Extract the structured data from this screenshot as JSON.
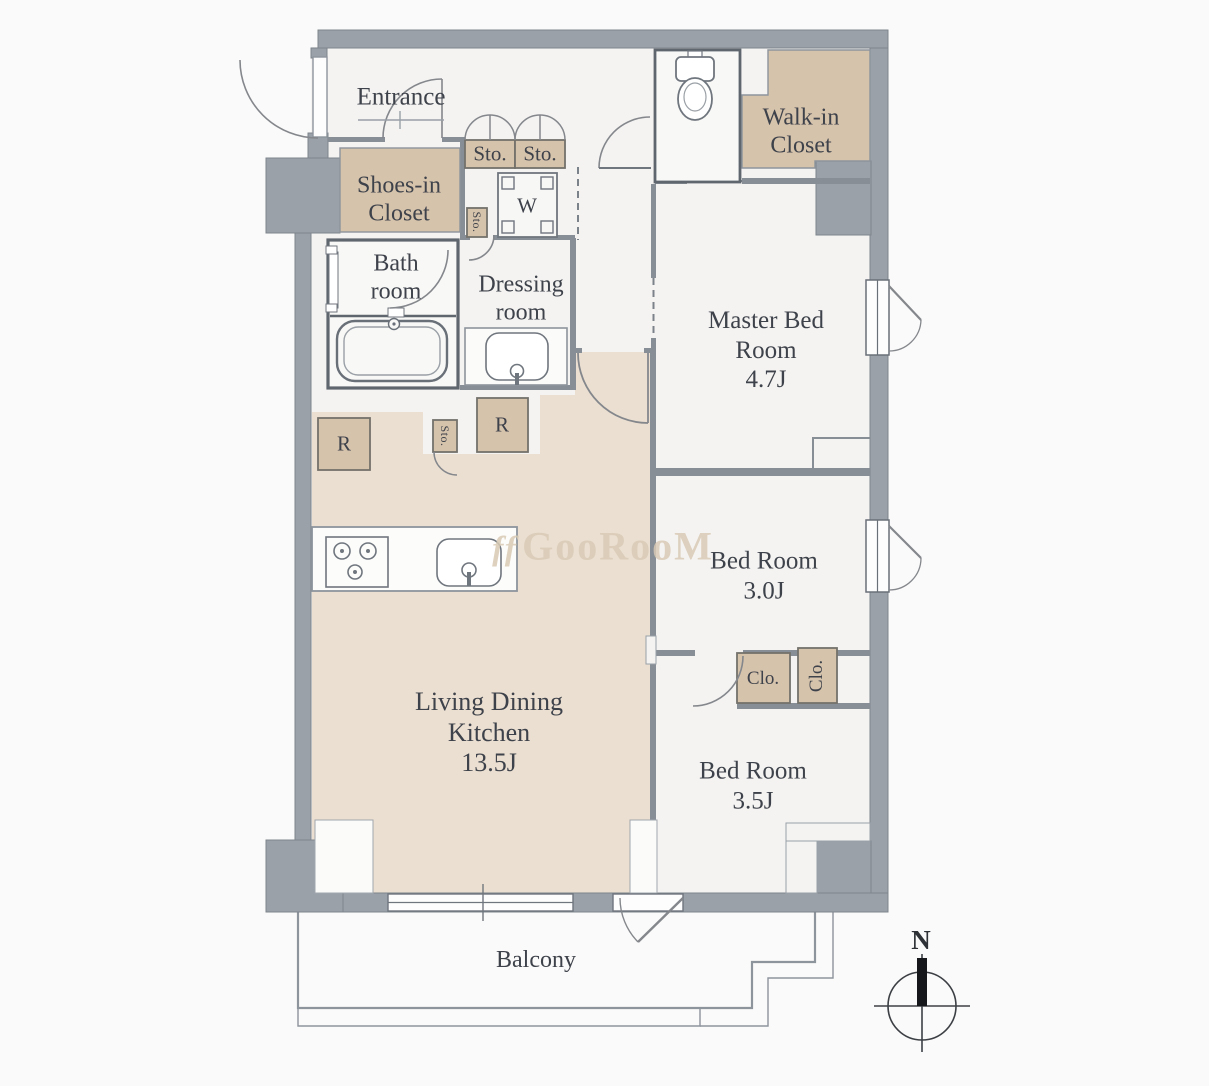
{
  "title": "apartment-floor-plan",
  "watermark": {
    "prefix": "ff",
    "text": "GooRooM"
  },
  "compass": {
    "north": "N"
  },
  "labels": {
    "entrance": "Entrance",
    "shoes_closet_1": "Shoes-in",
    "shoes_closet_2": "Closet",
    "sto_left": "Sto.",
    "sto_right": "Sto.",
    "hall_sto": "Sto.",
    "washer": "W",
    "bath_1": "Bath",
    "bath_2": "room",
    "dressing_1": "Dressing",
    "dressing_2": "room",
    "walkin_1": "Walk-in",
    "walkin_2": "Closet",
    "master_1": "Master Bed",
    "master_2": "Room",
    "master_size": "4.7J",
    "bed2_1": "Bed Room",
    "bed2_size": "3.0J",
    "clo_h": "Clo.",
    "clo_v": "Clo.",
    "bed3_1": "Bed Room",
    "bed3_size": "3.5J",
    "ldk_1": "Living Dining",
    "ldk_2": "Kitchen",
    "ldk_size": "13.5J",
    "fridge_left": "R",
    "fridge_right": "R",
    "kitchen_sto": "Sto.",
    "balcony": "Balcony"
  },
  "colors": {
    "wall_gray": "#9aa1a9",
    "closet_tan": "#d6c3ac",
    "ldk_floor_tan": "#ebdfd1",
    "room_floor": "#f4f3f2",
    "fixture_white": "#fcfcfb",
    "line_dark": "#60666d",
    "text": "#3e424a",
    "watermark": "#d9cbb5"
  }
}
